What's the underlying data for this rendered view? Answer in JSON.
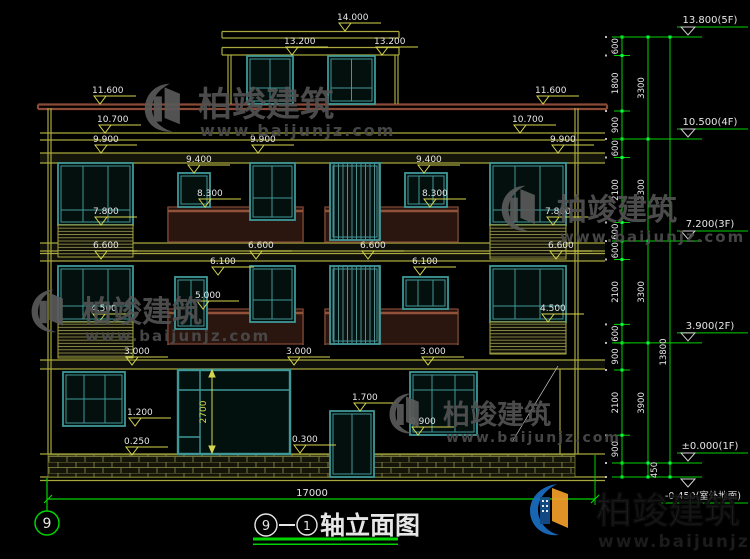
{
  "watermark": {
    "brand": "柏竣建筑",
    "url": "www.baijunjz.com"
  },
  "title": {
    "axis_left": "9",
    "axis_right": "1",
    "name": "轴立面图"
  },
  "axis_bubble_label": "9",
  "bottom_dim_total": "17000",
  "vertical_dim_2700": {
    "t": "2700"
  },
  "elevation_labels": [
    {
      "t": "14.000",
      "x": 345,
      "y": 31
    },
    {
      "t": "13.200",
      "x": 292,
      "y": 55
    },
    {
      "t": "13.200",
      "x": 382,
      "y": 55
    },
    {
      "t": "11.600",
      "x": 100,
      "y": 104
    },
    {
      "t": "11.600",
      "x": 543,
      "y": 104
    },
    {
      "t": "10.700",
      "x": 105,
      "y": 133
    },
    {
      "t": "10.700",
      "x": 520,
      "y": 133
    },
    {
      "t": "9.900",
      "x": 101,
      "y": 153
    },
    {
      "t": "9.900",
      "x": 258,
      "y": 153
    },
    {
      "t": "9.900",
      "x": 558,
      "y": 153
    },
    {
      "t": "9.400",
      "x": 194,
      "y": 173
    },
    {
      "t": "9.400",
      "x": 424,
      "y": 173
    },
    {
      "t": "8.300",
      "x": 205,
      "y": 207
    },
    {
      "t": "8.300",
      "x": 430,
      "y": 207
    },
    {
      "t": "7.800",
      "x": 101,
      "y": 225
    },
    {
      "t": "7.800",
      "x": 553,
      "y": 225
    },
    {
      "t": "6.600",
      "x": 101,
      "y": 259
    },
    {
      "t": "6.600",
      "x": 256,
      "y": 259
    },
    {
      "t": "6.600",
      "x": 368,
      "y": 259
    },
    {
      "t": "6.600",
      "x": 556,
      "y": 259
    },
    {
      "t": "6.100",
      "x": 218,
      "y": 275
    },
    {
      "t": "6.100",
      "x": 420,
      "y": 275
    },
    {
      "t": "5.000",
      "x": 203,
      "y": 309
    },
    {
      "t": "4.500",
      "x": 99,
      "y": 322
    },
    {
      "t": "4.500",
      "x": 548,
      "y": 322
    },
    {
      "t": "3.000",
      "x": 132,
      "y": 365
    },
    {
      "t": "3.000",
      "x": 294,
      "y": 365
    },
    {
      "t": "3.000",
      "x": 428,
      "y": 365
    },
    {
      "t": "1.700",
      "x": 360,
      "y": 411
    },
    {
      "t": "1.200",
      "x": 135,
      "y": 426
    },
    {
      "t": "0.900",
      "x": 418,
      "y": 435
    },
    {
      "t": "0.300",
      "x": 300,
      "y": 453
    },
    {
      "t": "0.250",
      "x": 132,
      "y": 455
    }
  ],
  "chain": {
    "segments": [
      {
        "t": "600",
        "a": 37,
        "b": 55.5
      },
      {
        "t": "1800",
        "a": 55.5,
        "b": 111
      },
      {
        "t": "900",
        "a": 111,
        "b": 139
      },
      {
        "t": "600",
        "a": 139,
        "b": 157.5
      },
      {
        "t": "2100",
        "a": 157.5,
        "b": 222.5
      },
      {
        "t": "600",
        "a": 222.5,
        "b": 241
      },
      {
        "t": "600",
        "a": 241,
        "b": 259.5
      },
      {
        "t": "2100",
        "a": 259.5,
        "b": 324.4
      },
      {
        "t": "600",
        "a": 324.4,
        "b": 342.9
      },
      {
        "t": "900",
        "a": 342.9,
        "b": 370
      },
      {
        "t": "2100",
        "a": 370,
        "b": 435.2
      },
      {
        "t": "900",
        "a": 435.2,
        "b": 463
      }
    ],
    "groups": [
      {
        "t": "3300",
        "a": 37,
        "b": 139
      },
      {
        "t": "3300",
        "a": 139,
        "b": 241
      },
      {
        "t": "3300",
        "a": 241,
        "b": 342.9
      },
      {
        "t": "3900",
        "a": 342.9,
        "b": 463
      }
    ],
    "total": {
      "t": "13800",
      "a": 37,
      "b": 463
    },
    "footing": {
      "t": "450",
      "a": 463,
      "b": 477
    }
  },
  "levels": [
    {
      "t": "13.800(5F)",
      "y": 37
    },
    {
      "t": "10.500(4F)",
      "y": 139
    },
    {
      "t": "7.200(3F)",
      "y": 241
    },
    {
      "t": "3.900(2F)",
      "y": 342.9
    },
    {
      "t": "±0.000(1F)",
      "y": 463
    },
    {
      "t": "-0.450(室外地面)",
      "y": 477,
      "below": true
    }
  ],
  "colors": {
    "background": "#000000",
    "cad_yellow": "#a8a83e",
    "dim_yellow": "#d6d64e",
    "cad_green": "#00d400",
    "window_teal": "#3f9898",
    "fascia_brown": "#8a4a36",
    "rail_brown": "#7b4433",
    "text_white": "#e6e6e6",
    "watermark_gray": "#525252",
    "logo_blue": "#1a6fc4",
    "logo_orange": "#f5a02a"
  }
}
